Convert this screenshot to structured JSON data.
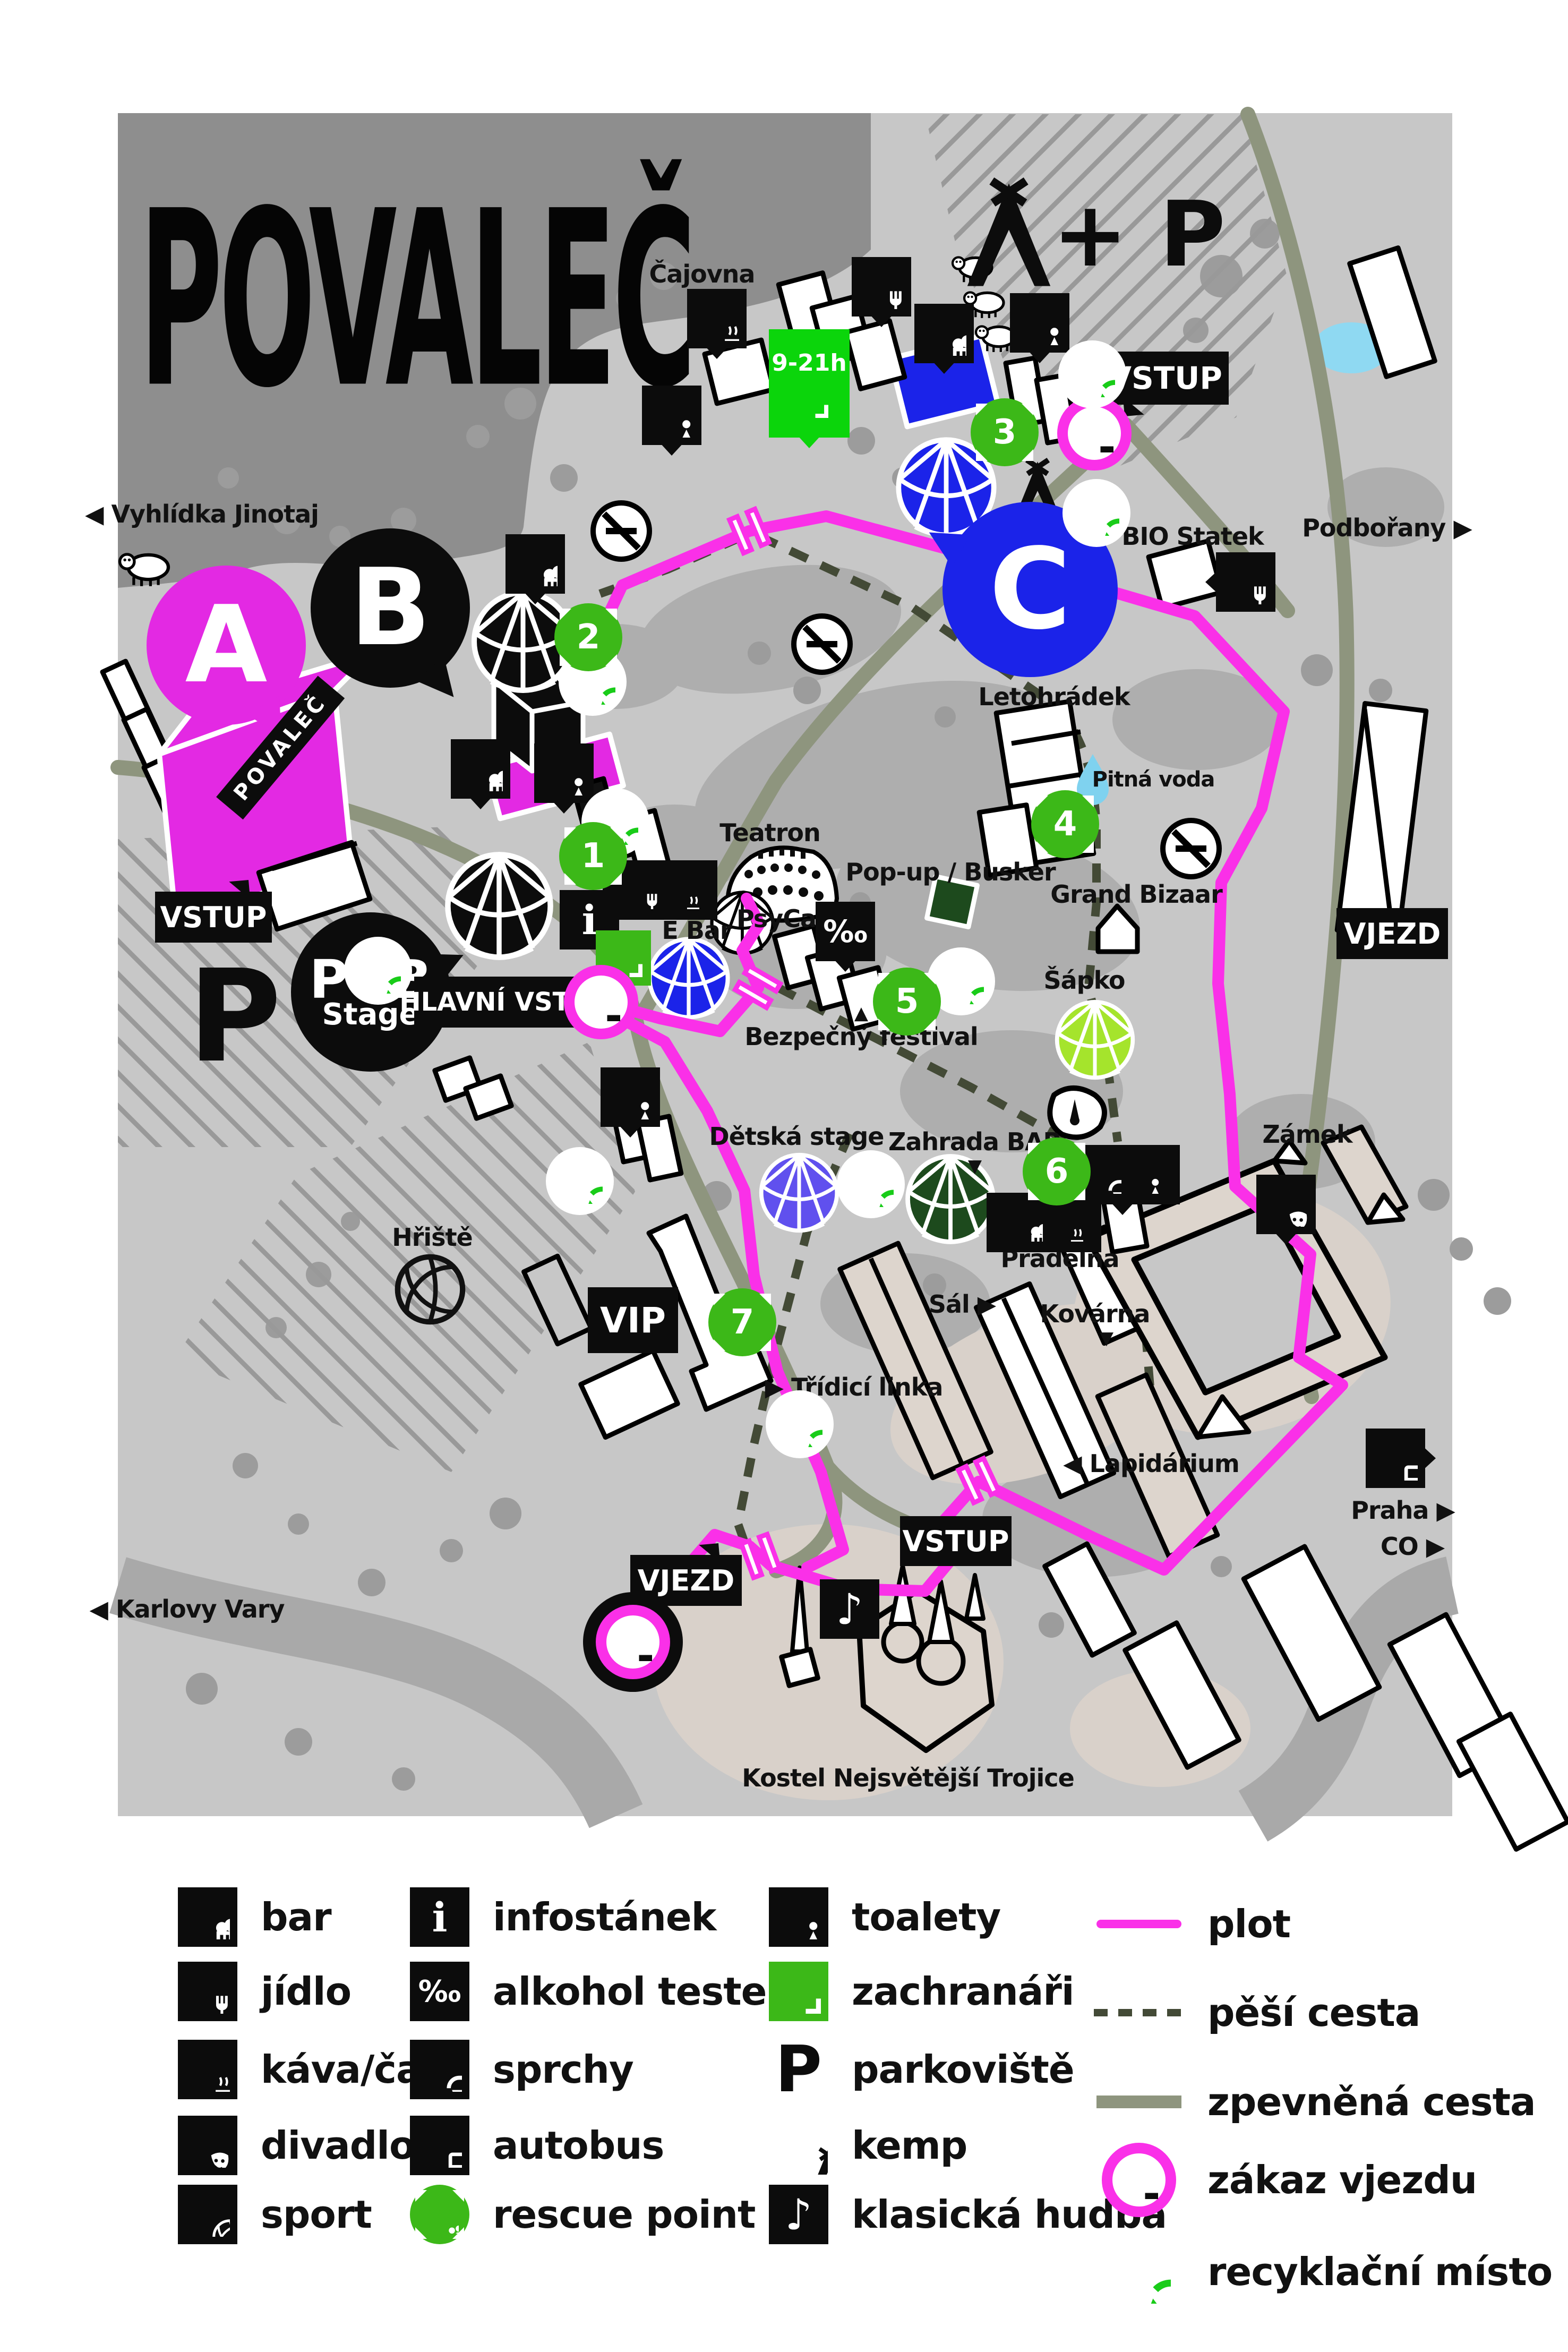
{
  "title": "POVALEČ",
  "map": {
    "labels": {
      "vyhlidka": "◀ Vyhlídka Jinotaj",
      "cajovna": "Čajovna",
      "podborany": "Podbořany ▶",
      "bio_statek": "BIO Statek",
      "letohradek": "Letohrádek",
      "pitna_voda": "Pitná voda",
      "teatron": "Teatron",
      "popup_busker": "Pop-up / Busker",
      "psycare": "PsyCare",
      "e_bar": "E Bar",
      "bezpecny_festival": "Bezpečný festival",
      "grand_bizaar": "Grand Bizaar",
      "sapko": "Šápko",
      "zamek": "Zámek",
      "detska_stage": "Dětská stage",
      "zahrada_bar": "Zahrada BAR",
      "pradelna": "Prádelna",
      "sal": "Sál ▶",
      "kovarna": "Kovárna",
      "hriste": "Hřiště",
      "tridici_linka": "▶ Třídicí linka",
      "lapidarium": "◀ Lapidárium",
      "kostel": "Kostel Nejsvětější Trojice",
      "karlovy_vary": "◀ Karlovy Vary",
      "praha": "Praha ▶",
      "co": "CO ▶"
    },
    "stages": {
      "a": "A",
      "b": "B",
      "c": "C",
      "pub_line1": "PUB",
      "pub_line2": "Stage"
    },
    "signs": {
      "vstup": "VSTUP",
      "hlavni_vstup": "HLAVNÍ VSTUP",
      "vjezd": "VJEZD",
      "vip": "VIP",
      "parking": "P",
      "camp_parking": "+ P",
      "hours": "9-21h",
      "banner": "POVALEČ"
    },
    "rescue_numbers": [
      "1",
      "2",
      "3",
      "4",
      "5",
      "6",
      "7"
    ]
  },
  "icons": {
    "info": "i",
    "permille": "‰",
    "music": "♪",
    "tri_down": "▼",
    "tri_up": "▲"
  },
  "legend": {
    "items": [
      {
        "icon": "beer-icon",
        "label": "bar"
      },
      {
        "icon": "food-icon",
        "label": "jídlo"
      },
      {
        "icon": "coffee-icon",
        "label": "káva/čaj"
      },
      {
        "icon": "theater-masks-icon",
        "label": "divadlo"
      },
      {
        "icon": "basketball-icon",
        "label": "sport"
      },
      {
        "icon": "info-icon",
        "label": "infostánek"
      },
      {
        "icon": "permille-icon",
        "label": "alkohol tester"
      },
      {
        "icon": "shower-icon",
        "label": "sprchy"
      },
      {
        "icon": "bus-icon",
        "label": "autobus"
      },
      {
        "icon": "rescue-point-icon",
        "label": "rescue point"
      },
      {
        "icon": "toilets-icon",
        "label": "toalety"
      },
      {
        "icon": "medic-cross-icon",
        "label": "zachranáři"
      },
      {
        "icon": "parking-icon",
        "label": "parkoviště"
      },
      {
        "icon": "tent-icon",
        "label": "kemp"
      },
      {
        "icon": "music-note-icon",
        "label": "klasická hudba"
      },
      {
        "icon": "fence-line-sample",
        "label": "plot"
      },
      {
        "icon": "dashed-line-sample",
        "label": "pěší cesta"
      },
      {
        "icon": "road-line-sample",
        "label": "zpevněná cesta"
      },
      {
        "icon": "no-entry-icon",
        "label": "zákaz vjezdu"
      },
      {
        "icon": "recycle-icon",
        "label": "recyklační místo"
      }
    ]
  },
  "colors": {
    "fence_magenta": "#fa30e8",
    "stage_a_magenta": "#e329e3",
    "stage_c_blue": "#1b23e9",
    "rescue_green": "#3cb818",
    "medic_bright_green": "#0bd50b",
    "dark_green": "#1d4a1d",
    "kids_purple": "#6050ee",
    "sapko_lime": "#a5e42c",
    "road_olive": "#8e957e",
    "path_dark_olive": "#434a36",
    "map_gray": "#c7c7c7",
    "map_dark_gray": "#8e8e8e",
    "ground_beige": "#d9d1ca",
    "water_cyan": "#8fd9f2"
  }
}
